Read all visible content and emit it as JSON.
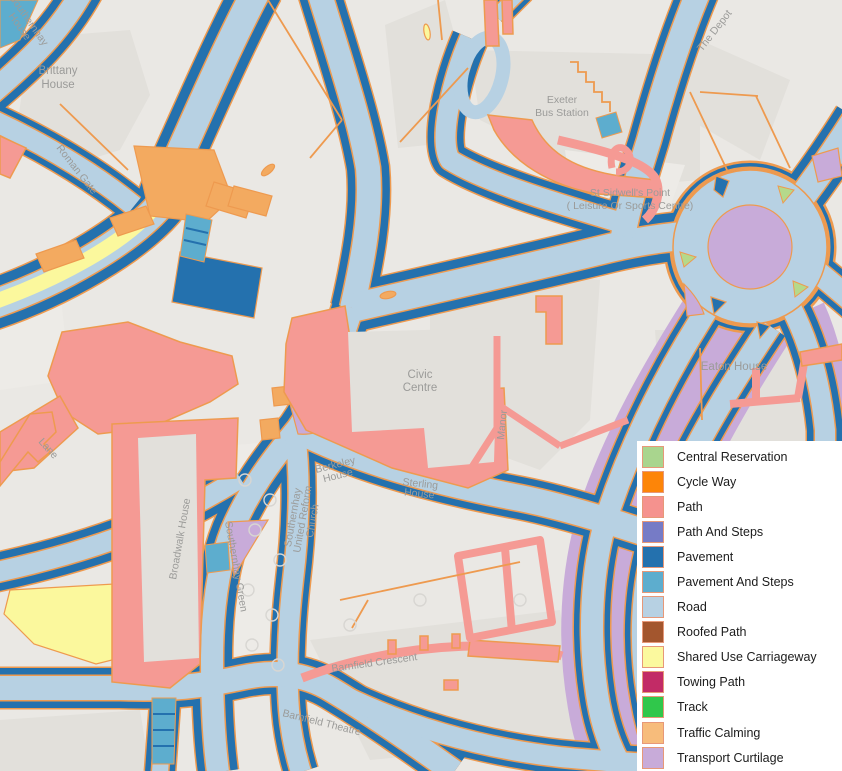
{
  "colors": {
    "background": "#eae8e4",
    "building": "#e2e0db",
    "building_light": "#edebe7",
    "road": "#b7d1e3",
    "pavement": "#2471ae",
    "pavement_steps": "#5dadce",
    "path": "#f59a94",
    "casing": "#ee9a4f",
    "shared_use": "#fbf89d",
    "traffic_calming": "#f3aa60",
    "curtilage": "#c8abd9",
    "central_reservation": "#b5d98b",
    "label": "#9b9b99",
    "tree": "#d8d6d2",
    "swatch_border": "#e79878"
  },
  "legend": {
    "items": [
      {
        "label": "Central Reservation",
        "color": "#a9d58e"
      },
      {
        "label": "Cycle Way",
        "color": "#fd8508"
      },
      {
        "label": "Path",
        "color": "#f5928e"
      },
      {
        "label": "Path And Steps",
        "color": "#767bc6"
      },
      {
        "label": "Pavement",
        "color": "#2471ae"
      },
      {
        "label": "Pavement And Steps",
        "color": "#5dadce"
      },
      {
        "label": "Road",
        "color": "#b7d1e3"
      },
      {
        "label": "Roofed Path",
        "color": "#a3562e"
      },
      {
        "label": "Shared Use Carriageway",
        "color": "#fbf99e"
      },
      {
        "label": "Towing Path",
        "color": "#c22b66"
      },
      {
        "label": "Track",
        "color": "#30c74b"
      },
      {
        "label": "Traffic Calming",
        "color": "#f7bc7b"
      },
      {
        "label": "Transport Curtilage",
        "color": "#c8abd9"
      }
    ]
  },
  "map": {
    "labels": {
      "southernhay_house_1": "Southernhay",
      "southernhay_house_2": "House",
      "brittany_1": "Brittany",
      "brittany_2": "House",
      "roman_gate": "Roman Gate",
      "the_depot": "The Depot",
      "bus_station_1": "Exeter",
      "bus_station_2": "Bus Station",
      "sidwells_1": "St Sidwell's Point",
      "sidwells_2": "( Leisure Or Sports Centre)",
      "eaton_house": "Eaton House",
      "civic_1": "Civic",
      "civic_2": "Centre",
      "manor": "Manor",
      "berkeley_1": "Berkeley",
      "berkeley_2": "House",
      "sterling_1": "Sterling",
      "sterling_2": "House",
      "church_1": "Southernhay",
      "church_2": "United Reform",
      "church_3": "Church",
      "broadwalk": "Broadwalk House",
      "southernhay_green": "Southernhay Green",
      "lane": "Lane",
      "barnfield_crescent": "Barnfield Crescent",
      "barnfield_theatre": "Barnfield Theatre"
    }
  }
}
